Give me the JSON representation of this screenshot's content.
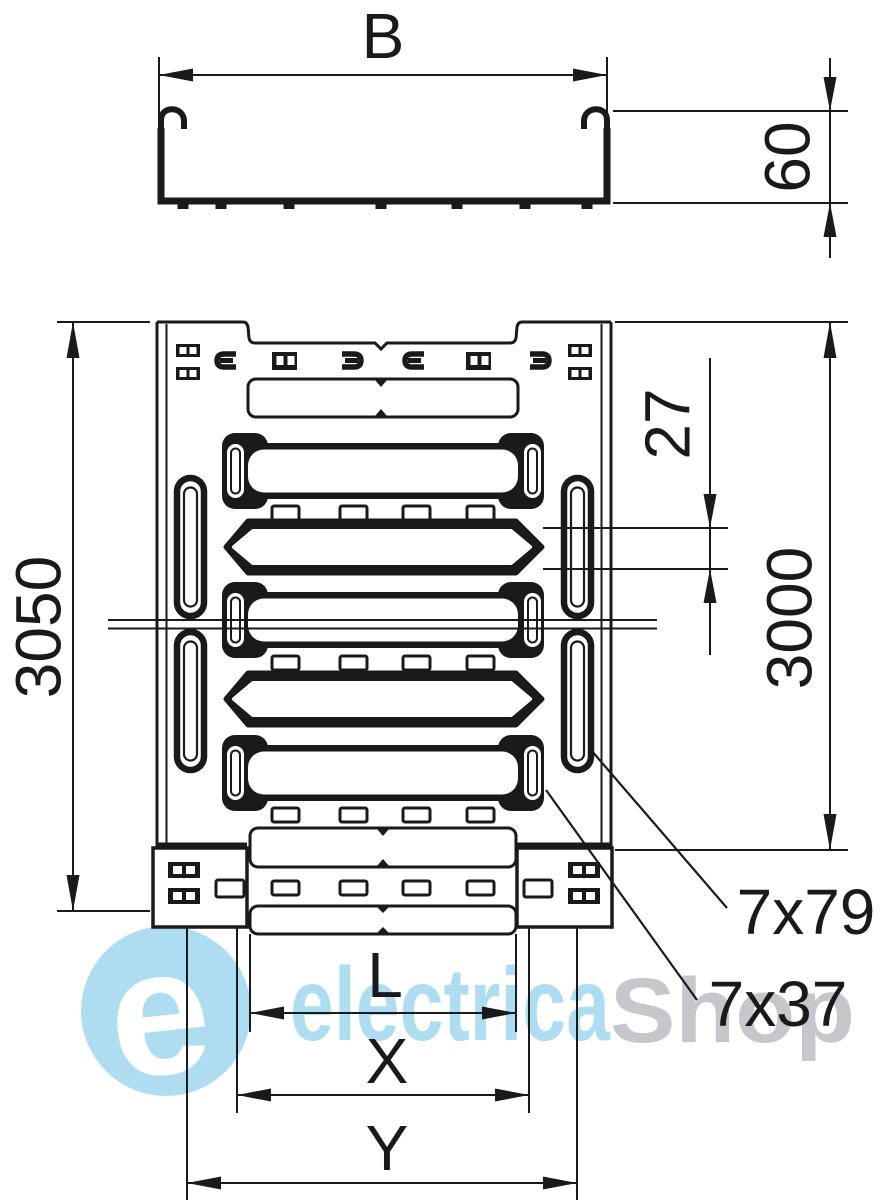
{
  "drawing": {
    "labels": {
      "width": "B",
      "height": "60",
      "overall_length": "3050",
      "section_length": "3000",
      "pitch": "27",
      "side_perforation": "7x79",
      "base_perforation": "7x37",
      "dim_l": "L",
      "dim_x": "X",
      "dim_y": "Y"
    },
    "ink": "#1a1a1a",
    "background": "#ffffff"
  },
  "watermark": {
    "logo_letter": "e",
    "brand_left": "electrica",
    "brand_right": "Shop",
    "blue": "#aeddf2",
    "gray": "#c6c7ca"
  }
}
